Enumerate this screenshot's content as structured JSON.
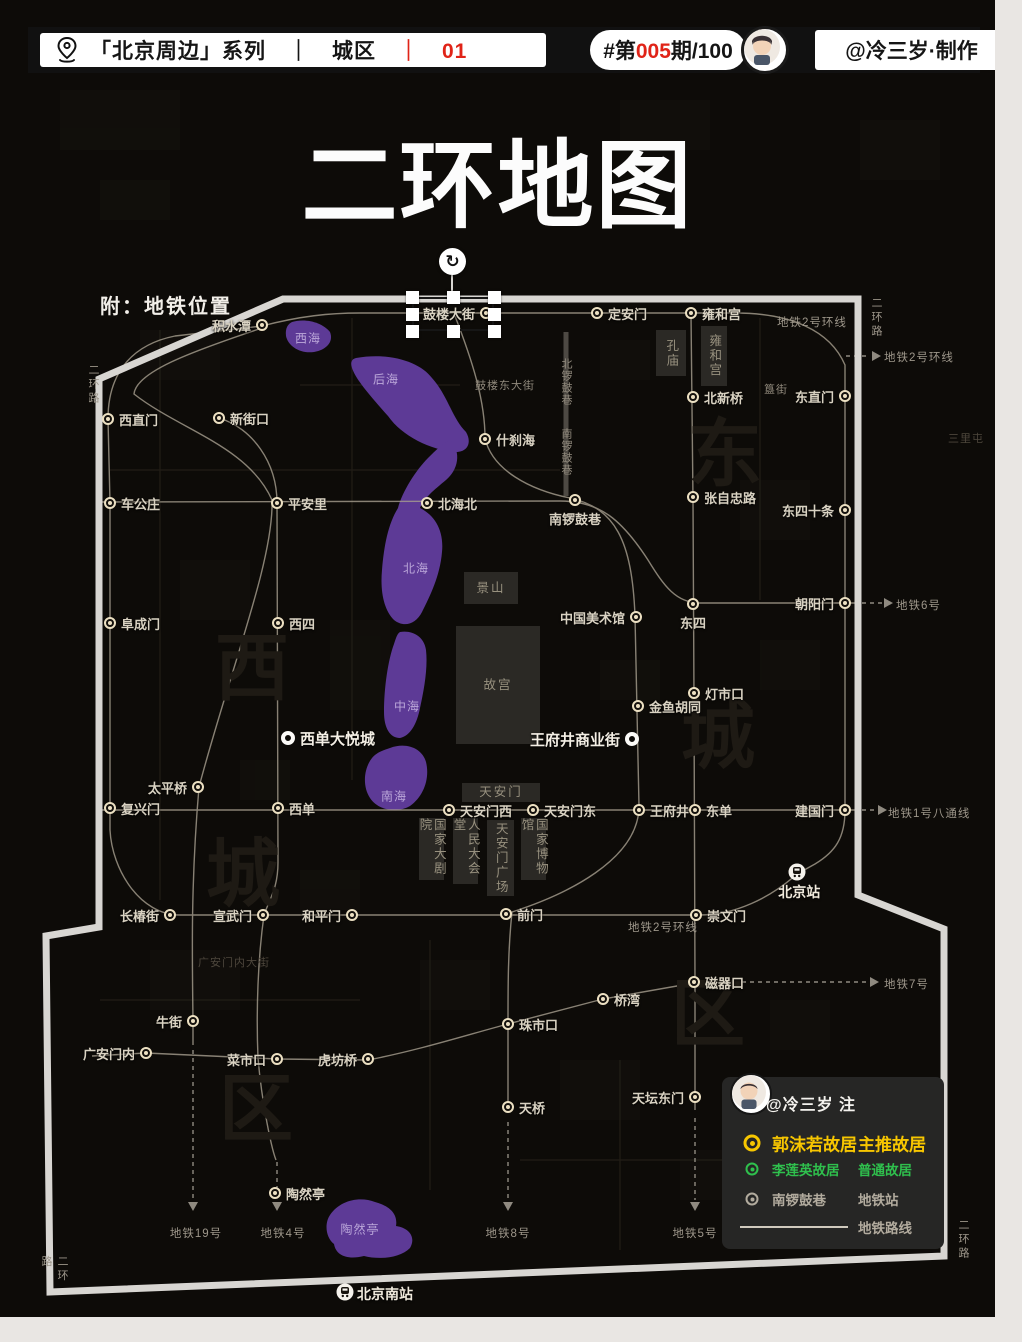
{
  "header": {
    "series": "「北京周边」系列",
    "sep1": "｜",
    "area": "城区",
    "sep2": "｜",
    "num": "01",
    "issue_prefix": "#第",
    "issue_num": "005",
    "issue_suffix": "期/100",
    "author": "@冷三岁·制作"
  },
  "title": "二环地图",
  "subtitle": "附：地铁位置",
  "colors": {
    "accent_red": "#e02418",
    "water_purple": "#5d3a96",
    "ring_road": "#d8d6d2",
    "station_ring": "#ece0c2",
    "legend_yellow": "#f7c600",
    "legend_green": "#2fc04d"
  },
  "selection": {
    "station_label": "鼓楼大街"
  },
  "map": {
    "stations": [
      {
        "n": "积水潭",
        "x": 262,
        "y": 325,
        "s": "left"
      },
      {
        "n": "鼓楼大街",
        "x": 486,
        "y": 313,
        "s": "left"
      },
      {
        "n": "定安门",
        "x": 597,
        "y": 313,
        "s": "right"
      },
      {
        "n": "雍和宫",
        "x": 691,
        "y": 313,
        "s": "right"
      },
      {
        "n": "东直门",
        "x": 845,
        "y": 396,
        "s": "left"
      },
      {
        "n": "东四十条",
        "x": 845,
        "y": 510,
        "s": "left"
      },
      {
        "n": "朝阳门",
        "x": 845,
        "y": 603,
        "s": "left"
      },
      {
        "n": "建国门",
        "x": 845,
        "y": 810,
        "s": "left"
      },
      {
        "n": "崇文门",
        "x": 696,
        "y": 915,
        "s": "right"
      },
      {
        "n": "前门",
        "x": 506,
        "y": 914,
        "s": "right"
      },
      {
        "n": "和平门",
        "x": 352,
        "y": 915,
        "s": "left"
      },
      {
        "n": "宣武门",
        "x": 263,
        "y": 915,
        "s": "left"
      },
      {
        "n": "长椿街",
        "x": 170,
        "y": 915,
        "s": "left"
      },
      {
        "n": "复兴门",
        "x": 110,
        "y": 808,
        "s": "right"
      },
      {
        "n": "阜成门",
        "x": 110,
        "y": 623,
        "s": "right"
      },
      {
        "n": "车公庄",
        "x": 110,
        "y": 503,
        "s": "right"
      },
      {
        "n": "西直门",
        "x": 108,
        "y": 419,
        "s": "right"
      },
      {
        "n": "新街口",
        "x": 219,
        "y": 418,
        "s": "right"
      },
      {
        "n": "平安里",
        "x": 277,
        "y": 503,
        "s": "right"
      },
      {
        "n": "西四",
        "x": 278,
        "y": 623,
        "s": "right"
      },
      {
        "n": "西单",
        "x": 278,
        "y": 808,
        "s": "right"
      },
      {
        "n": "太平桥",
        "x": 198,
        "y": 787,
        "s": "left"
      },
      {
        "n": "牛街",
        "x": 193,
        "y": 1021,
        "s": "left"
      },
      {
        "n": "广安门内",
        "x": 146,
        "y": 1053,
        "s": "left"
      },
      {
        "n": "菜市口",
        "x": 277,
        "y": 1059,
        "s": "left"
      },
      {
        "n": "虎坊桥",
        "x": 368,
        "y": 1059,
        "s": "left"
      },
      {
        "n": "珠市口",
        "x": 508,
        "y": 1024,
        "s": "right"
      },
      {
        "n": "桥湾",
        "x": 603,
        "y": 999,
        "s": "right"
      },
      {
        "n": "磁器口",
        "x": 694,
        "y": 982,
        "s": "right"
      },
      {
        "n": "天桥",
        "x": 508,
        "y": 1107,
        "s": "right"
      },
      {
        "n": "天坛东门",
        "x": 695,
        "y": 1097,
        "s": "left"
      },
      {
        "n": "陶然亭",
        "x": 275,
        "y": 1193,
        "s": "right"
      },
      {
        "n": "北新桥",
        "x": 693,
        "y": 397,
        "s": "right"
      },
      {
        "n": "张自忠路",
        "x": 693,
        "y": 497,
        "s": "right"
      },
      {
        "n": "东四",
        "x": 693,
        "y": 604,
        "s": "below"
      },
      {
        "n": "灯市口",
        "x": 694,
        "y": 693,
        "s": "right"
      },
      {
        "n": "金鱼胡同",
        "x": 638,
        "y": 706,
        "s": "right"
      },
      {
        "n": "中国美术馆",
        "x": 636,
        "y": 617,
        "s": "left"
      },
      {
        "n": "北海北",
        "x": 427,
        "y": 503,
        "s": "right"
      },
      {
        "n": "什刹海",
        "x": 485,
        "y": 439,
        "s": "right"
      },
      {
        "n": "南锣鼓巷",
        "x": 575,
        "y": 500,
        "s": "below"
      },
      {
        "n": "东单",
        "x": 695,
        "y": 810,
        "s": "right"
      },
      {
        "n": "王府井",
        "x": 639,
        "y": 810,
        "s": "right"
      },
      {
        "n": "天安门西",
        "x": 449,
        "y": 810,
        "s": "right"
      },
      {
        "n": "天安门东",
        "x": 533,
        "y": 810,
        "s": "right"
      }
    ],
    "pois": [
      {
        "n": "西单大悦城",
        "x": 288,
        "y": 738,
        "s": "right"
      },
      {
        "n": "王府井商业街",
        "x": 632,
        "y": 739,
        "s": "left"
      }
    ],
    "rails": [
      {
        "n": "北京站",
        "x": 797,
        "y": 872,
        "s": "below"
      },
      {
        "n": "北京南站",
        "x": 345,
        "y": 1292,
        "s": "right"
      }
    ],
    "landmarks": [
      {
        "t": "孔庙",
        "x": 656,
        "y": 330,
        "w": 30,
        "h": 46,
        "v": true
      },
      {
        "t": "雍和宫",
        "x": 701,
        "y": 326,
        "w": 26,
        "h": 60,
        "v": true
      },
      {
        "t": "景山",
        "x": 464,
        "y": 572,
        "w": 54,
        "h": 32,
        "v": false
      },
      {
        "t": "故宫",
        "x": 456,
        "y": 626,
        "w": 84,
        "h": 118,
        "v": false
      },
      {
        "t": "天安门",
        "x": 462,
        "y": 783,
        "w": 78,
        "h": 19,
        "v": false
      },
      {
        "t": "国家大剧院",
        "x": 419,
        "y": 818,
        "w": 25,
        "h": 62,
        "v": true
      },
      {
        "t": "人民大会堂",
        "x": 453,
        "y": 818,
        "w": 25,
        "h": 66,
        "v": true
      },
      {
        "t": "天安门广场",
        "x": 487,
        "y": 820,
        "w": 27,
        "h": 76,
        "v": true
      },
      {
        "t": "国家博物馆",
        "x": 521,
        "y": 818,
        "w": 25,
        "h": 62,
        "v": true
      }
    ],
    "lake_labels": [
      {
        "t": "西海",
        "x": 308,
        "y": 338
      },
      {
        "t": "后海",
        "x": 386,
        "y": 379
      },
      {
        "t": "北海",
        "x": 416,
        "y": 568
      },
      {
        "t": "中海",
        "x": 407,
        "y": 706
      },
      {
        "t": "南海",
        "x": 394,
        "y": 796
      },
      {
        "t": "陶然亭",
        "x": 360,
        "y": 1229
      }
    ],
    "street_labels": [
      {
        "t": "鼓楼东大街",
        "x": 505,
        "y": 385,
        "v": false,
        "faint": false
      },
      {
        "t": "北锣鼓巷",
        "x": 566,
        "y": 382,
        "v": true,
        "faint": false
      },
      {
        "t": "南锣鼓巷",
        "x": 566,
        "y": 452,
        "v": true,
        "faint": false
      },
      {
        "t": "簋街",
        "x": 776,
        "y": 389,
        "v": false,
        "faint": false
      },
      {
        "t": "广安门内大街",
        "x": 234,
        "y": 962,
        "v": false,
        "faint": true
      },
      {
        "t": "三里屯",
        "x": 966,
        "y": 438,
        "v": false,
        "faint": true
      }
    ],
    "line_labels": [
      {
        "t": "地铁2号环线",
        "x": 777,
        "y": 321,
        "a": "left"
      },
      {
        "t": "地铁2号环线",
        "x": 884,
        "y": 356,
        "a": "left"
      },
      {
        "t": "地铁2号环线",
        "x": 628,
        "y": 926,
        "a": "left"
      },
      {
        "t": "地铁6号",
        "x": 896,
        "y": 604,
        "a": "left"
      },
      {
        "t": "地铁1号八通线",
        "x": 888,
        "y": 812,
        "a": "left"
      },
      {
        "t": "地铁7号",
        "x": 884,
        "y": 983,
        "a": "left"
      },
      {
        "t": "地铁19号",
        "x": 196,
        "y": 1233,
        "a": "center"
      },
      {
        "t": "地铁4号",
        "x": 283,
        "y": 1233,
        "a": "center"
      },
      {
        "t": "地铁8号",
        "x": 508,
        "y": 1233,
        "a": "center"
      },
      {
        "t": "地铁5号",
        "x": 695,
        "y": 1233,
        "a": "center"
      }
    ],
    "ring_labels": [
      {
        "t": "二环路",
        "x": 93,
        "y": 385
      },
      {
        "t": "二环路",
        "x": 876,
        "y": 318
      },
      {
        "t": "二环路",
        "x": 54,
        "y": 1276
      },
      {
        "t": "二环路",
        "x": 963,
        "y": 1240
      }
    ],
    "watermarks": [
      {
        "t": "西",
        "x": 252,
        "y": 662
      },
      {
        "t": "城",
        "x": 243,
        "y": 868
      },
      {
        "t": "区",
        "x": 256,
        "y": 1103
      },
      {
        "t": "东",
        "x": 725,
        "y": 448
      },
      {
        "t": "城",
        "x": 718,
        "y": 730
      },
      {
        "t": "区",
        "x": 708,
        "y": 1008
      }
    ]
  },
  "legend": {
    "author_note": "@冷三岁 注",
    "rows": [
      {
        "icon": "yellow-ring",
        "name": "郭沫若故居",
        "type": "主推故居",
        "color": "#f7c600",
        "size": 17,
        "bold": true
      },
      {
        "icon": "green-ring",
        "name": "李莲英故居",
        "type": "普通故居",
        "color": "#2fc04d",
        "size": 13.5,
        "bold": true
      },
      {
        "icon": "metro-ring",
        "name": "南锣鼓巷",
        "type": "地铁站",
        "color": "#b2ab9e",
        "size": 13.5,
        "bold": false
      },
      {
        "icon": "line",
        "name": "",
        "type": "地铁路线",
        "color": "#b2ab9e",
        "size": 13.5,
        "bold": false
      }
    ]
  }
}
